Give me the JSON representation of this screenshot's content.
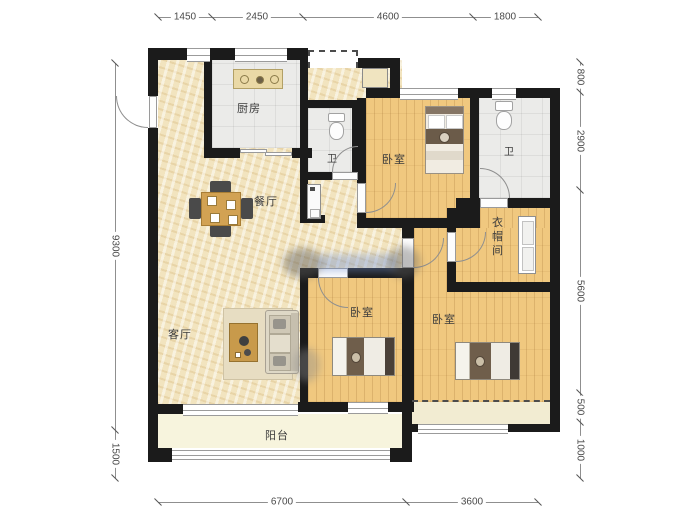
{
  "rooms": {
    "kitchen": "厨房",
    "bath_a": "卫",
    "bath_b": "卫",
    "bedroom_top": "卧室",
    "bedroom_middle": "卧室",
    "bedroom_right": "卧室",
    "dining": "餐厅",
    "living": "客厅",
    "cloakroom": "衣帽间",
    "balcony": "阳台"
  },
  "dimensions": {
    "top": [
      "1450",
      "2450",
      "4600",
      "1800"
    ],
    "bottom": [
      "6700",
      "3600"
    ],
    "left": [
      "9300",
      "1500"
    ],
    "right": [
      "800",
      "2900",
      "5600",
      "500",
      "1000"
    ]
  },
  "colors": {
    "wall": "#1b1b1b",
    "floor_marble": "#f2e4bf",
    "floor_wood": "#f0c87f",
    "floor_tile": "#ebebe9",
    "floor_balcony": "#f7f4dd",
    "dim_text": "#4a4a4a"
  }
}
